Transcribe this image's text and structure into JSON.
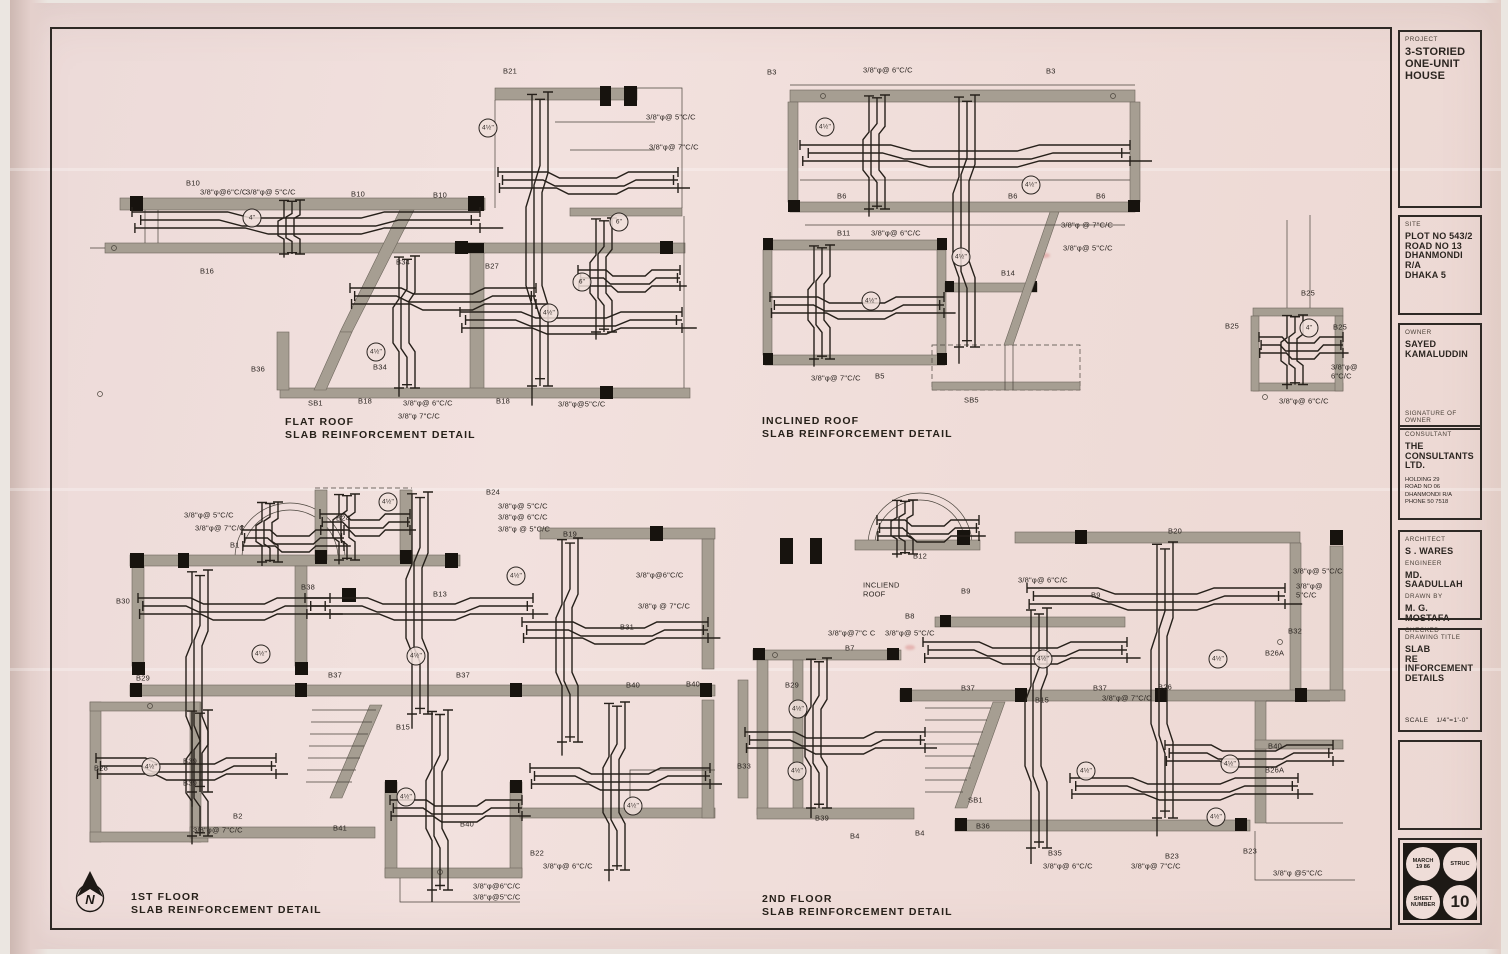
{
  "sheet": {
    "project": {
      "label": "PROJECT",
      "lines": [
        "3-STORIED",
        "ONE-UNIT",
        "HOUSE"
      ]
    },
    "site": {
      "label": "SITE",
      "lines": [
        "PLOT NO 543/2",
        "ROAD NO 13",
        "DHANMONDI R/A",
        "DHAKA 5"
      ]
    },
    "owner": {
      "label": "OWNER",
      "lines": [
        "SAYED",
        "KAMALUDDIN"
      ],
      "signature_label": "SIGNATURE OF OWNER"
    },
    "consultant": {
      "label": "CONSULTANT",
      "lines": [
        "THE",
        "CONSULTANTS",
        "LTD."
      ],
      "address": [
        "HOLDING  29",
        "ROAD NO  06",
        "DHANMONDI R/A",
        "PHONE  50 7518"
      ]
    },
    "team": {
      "architect_label": "ARCHITECT",
      "architect": "S . WARES",
      "engineer_label": "ENGINEER",
      "engineer": "MD. SAADULLAH",
      "drawn_label": "DRAWN BY",
      "drawn_by": "M. G. MOSTAFA",
      "checked_label": "CHECKED"
    },
    "title": {
      "label": "DRAWING TITLE",
      "lines": [
        "SLAB",
        "RE INFORCEMENT",
        "DETAILS"
      ],
      "scale_label": "SCALE",
      "scale": "1/4\"=1'-0\""
    },
    "stamp": {
      "date1": "MARCH",
      "date2": "19 86",
      "type": "STRUC",
      "sheet1": "SHEET",
      "sheet2": "NUMBER",
      "number": "10"
    }
  },
  "north_label": "N",
  "colors": {
    "paper": "#f0dfdc",
    "ink": "#2b2521",
    "wall": "#a69e92"
  },
  "drawings": {
    "flat_roof": {
      "title": "FLAT  ROOF",
      "subtitle": "SLAB  REINFORCEMENT  DETAIL",
      "annotations": [
        {
          "t": "B21",
          "x": 403,
          "y": 12
        },
        {
          "t": "3/8\"φ@ 5\"C/C",
          "x": 546,
          "y": 58
        },
        {
          "t": "3/8\"φ@ 7\"C/C",
          "x": 549,
          "y": 88
        },
        {
          "t": "B10",
          "x": 86,
          "y": 124
        },
        {
          "t": "3/8\"φ@6\"C/C",
          "x": 100,
          "y": 133
        },
        {
          "t": "3/8\"φ@ 5\"C/C",
          "x": 146,
          "y": 133
        },
        {
          "t": "4\"",
          "x": 152,
          "y": 158,
          "c": "circ"
        },
        {
          "t": "B16",
          "x": 100,
          "y": 212
        },
        {
          "t": "B10",
          "x": 251,
          "y": 135
        },
        {
          "t": "B10",
          "x": 333,
          "y": 136
        },
        {
          "t": "B27",
          "x": 385,
          "y": 207
        },
        {
          "t": "B34",
          "x": 296,
          "y": 203
        },
        {
          "t": "B34",
          "x": 273,
          "y": 308
        },
        {
          "t": "B36",
          "x": 151,
          "y": 310
        },
        {
          "t": "4½\"",
          "x": 388,
          "y": 68,
          "c": "circ"
        },
        {
          "t": "4½\"",
          "x": 276,
          "y": 292,
          "c": "circ"
        },
        {
          "t": "4½\"",
          "x": 449,
          "y": 253,
          "c": "circ"
        },
        {
          "t": "6\"",
          "x": 519,
          "y": 162,
          "c": "circ"
        },
        {
          "t": "6\"",
          "x": 482,
          "y": 222,
          "c": "circ"
        },
        {
          "t": "SB1",
          "x": 208,
          "y": 344
        },
        {
          "t": "B18",
          "x": 258,
          "y": 342
        },
        {
          "t": "3/8\"φ@ 6\"C/C",
          "x": 303,
          "y": 344
        },
        {
          "t": "3/8\"φ 7\"C/C",
          "x": 298,
          "y": 357
        },
        {
          "t": "B18",
          "x": 396,
          "y": 342
        },
        {
          "t": "3/8\"φ@5\"C/C",
          "x": 458,
          "y": 345
        }
      ]
    },
    "inclined_roof": {
      "title": "INCLINED  ROOF",
      "subtitle": "SLAB  REINFORCEMENT  DETAIL",
      "annotations": [
        {
          "t": "B3",
          "x": 22,
          "y": 18
        },
        {
          "t": "3/8\"φ@ 6\"C/C",
          "x": 118,
          "y": 16
        },
        {
          "t": "B3",
          "x": 301,
          "y": 17
        },
        {
          "t": "4½\"",
          "x": 80,
          "y": 72,
          "c": "circ"
        },
        {
          "t": "4½\"",
          "x": 286,
          "y": 130,
          "c": "circ"
        },
        {
          "t": "B6",
          "x": 92,
          "y": 142
        },
        {
          "t": "B6",
          "x": 263,
          "y": 142
        },
        {
          "t": "B6",
          "x": 351,
          "y": 142
        },
        {
          "t": "3/8\"φ @ 7\"C/C",
          "x": 316,
          "y": 171
        },
        {
          "t": "3/8\"φ@ 5\"C/C",
          "x": 318,
          "y": 194
        },
        {
          "t": "B11",
          "x": 92,
          "y": 179
        },
        {
          "t": "3/8\"φ@ 6\"C/C",
          "x": 126,
          "y": 179
        },
        {
          "t": "4½\"",
          "x": 216,
          "y": 202,
          "c": "circ"
        },
        {
          "t": "4½\"",
          "x": 126,
          "y": 246,
          "c": "circ"
        },
        {
          "t": "B14",
          "x": 256,
          "y": 219
        },
        {
          "t": "3/8\"φ@ 7\"C/C",
          "x": 66,
          "y": 324
        },
        {
          "t": "B5",
          "x": 130,
          "y": 322
        },
        {
          "t": "SB5",
          "x": 219,
          "y": 346
        }
      ]
    },
    "b25_detail": {
      "annotations": [
        {
          "t": "B25",
          "x": 86,
          "y": 79
        },
        {
          "t": "B25",
          "x": 10,
          "y": 112
        },
        {
          "t": "B25",
          "x": 118,
          "y": 113
        },
        {
          "t": "4\"",
          "x": 94,
          "y": 113,
          "c": "circ"
        },
        {
          "t": "3/8\"φ@ 6\"C/C",
          "x": 116,
          "y": 157
        },
        {
          "t": "3/8\"φ@ 6\"C/C",
          "x": 64,
          "y": 187
        }
      ]
    },
    "first_floor": {
      "title": "1ST  FLOOR",
      "subtitle": "SLAB  REINFORCEMENT  DETAIL",
      "annotations": [
        {
          "t": "B24",
          "x": 396,
          "y": 23
        },
        {
          "t": "3/8\"φ@ 5\"C/C",
          "x": 408,
          "y": 37
        },
        {
          "t": "3/8\"φ@ 6\"C/C",
          "x": 408,
          "y": 48
        },
        {
          "t": "3/8\"φ @ 5\"C/C",
          "x": 408,
          "y": 60
        },
        {
          "t": "B24",
          "x": 246,
          "y": 49
        },
        {
          "t": "3/8\"φ@ 5\"C/C",
          "x": 94,
          "y": 46
        },
        {
          "t": "3/8\"φ@ 7\"C/C",
          "x": 105,
          "y": 59
        },
        {
          "t": "B1",
          "x": 140,
          "y": 76
        },
        {
          "t": "B13",
          "x": 343,
          "y": 125
        },
        {
          "t": "B19",
          "x": 473,
          "y": 65
        },
        {
          "t": "4½\"",
          "x": 298,
          "y": 32,
          "c": "circ"
        },
        {
          "t": "4½\"",
          "x": 426,
          "y": 106,
          "c": "circ"
        },
        {
          "t": "3/8\"φ@6\"C/C",
          "x": 546,
          "y": 106
        },
        {
          "t": "3/8\"φ @ 7\"C/C",
          "x": 548,
          "y": 137
        },
        {
          "t": "B30",
          "x": 26,
          "y": 132
        },
        {
          "t": "B38",
          "x": 211,
          "y": 118
        },
        {
          "t": "B31",
          "x": 530,
          "y": 158
        },
        {
          "t": "4½\"",
          "x": 171,
          "y": 184,
          "c": "circ"
        },
        {
          "t": "4½\"",
          "x": 326,
          "y": 186,
          "c": "circ"
        },
        {
          "t": "B29",
          "x": 46,
          "y": 209
        },
        {
          "t": "B37",
          "x": 238,
          "y": 206
        },
        {
          "t": "B37",
          "x": 366,
          "y": 206
        },
        {
          "t": "B40",
          "x": 536,
          "y": 216
        },
        {
          "t": "B40",
          "x": 596,
          "y": 215
        },
        {
          "t": "B15",
          "x": 306,
          "y": 258
        },
        {
          "t": "B39",
          "x": 93,
          "y": 292
        },
        {
          "t": "4½\"",
          "x": 61,
          "y": 297,
          "c": "circ"
        },
        {
          "t": "B28",
          "x": 4,
          "y": 299
        },
        {
          "t": "B39",
          "x": 93,
          "y": 314
        },
        {
          "t": "B2",
          "x": 143,
          "y": 347
        },
        {
          "t": "3/8\"φ@ 7\"C/C",
          "x": 103,
          "y": 361
        },
        {
          "t": "B41",
          "x": 243,
          "y": 359
        },
        {
          "t": "4½\"",
          "x": 316,
          "y": 327,
          "c": "circ"
        },
        {
          "t": "4½\"",
          "x": 543,
          "y": 336,
          "c": "circ"
        },
        {
          "t": "B40",
          "x": 370,
          "y": 355
        },
        {
          "t": "B22",
          "x": 440,
          "y": 384
        },
        {
          "t": "3/8\"φ@ 6\"C/C",
          "x": 453,
          "y": 397
        },
        {
          "t": "3/8\"φ@6\"C/C",
          "x": 383,
          "y": 417
        },
        {
          "t": "3/8\"φ@5\"C/C",
          "x": 383,
          "y": 428
        }
      ]
    },
    "second_floor": {
      "title": "2ND  FLOOR",
      "subtitle": "SLAB REINFORCEMENT  DETAIL",
      "annotations": [
        {
          "t": "B12",
          "x": 178,
          "y": 67
        },
        {
          "t": "B20",
          "x": 433,
          "y": 42
        },
        {
          "t": "3/8\"φ@ 5\"C/C",
          "x": 558,
          "y": 82
        },
        {
          "t": "3/8\"φ@ 5\"C/C",
          "x": 561,
          "y": 101
        },
        {
          "t": "INCLIEND\nROOF",
          "x": 128,
          "y": 100
        },
        {
          "t": "B9",
          "x": 226,
          "y": 102
        },
        {
          "t": "3/8\"φ@ 6\"C/C",
          "x": 283,
          "y": 91
        },
        {
          "t": "B9",
          "x": 356,
          "y": 106
        },
        {
          "t": "B8",
          "x": 170,
          "y": 127
        },
        {
          "t": "B32",
          "x": 553,
          "y": 142
        },
        {
          "t": "3/8\"φ@7\"C C",
          "x": 93,
          "y": 144
        },
        {
          "t": "3/8\"φ@ 5\"C/C",
          "x": 150,
          "y": 144
        },
        {
          "t": "B7",
          "x": 110,
          "y": 159
        },
        {
          "t": "4½\"",
          "x": 308,
          "y": 169,
          "c": "circ"
        },
        {
          "t": "4½\"",
          "x": 483,
          "y": 169,
          "c": "circ"
        },
        {
          "t": "B29",
          "x": 50,
          "y": 196
        },
        {
          "t": "3/8\"φ@ 7\"C/C",
          "x": 367,
          "y": 209
        },
        {
          "t": "B37",
          "x": 226,
          "y": 199
        },
        {
          "t": "B37",
          "x": 358,
          "y": 199
        },
        {
          "t": "B26",
          "x": 423,
          "y": 198
        },
        {
          "t": "B26A",
          "x": 530,
          "y": 164
        },
        {
          "t": "B15",
          "x": 300,
          "y": 211
        },
        {
          "t": "4½\"",
          "x": 63,
          "y": 219,
          "c": "circ"
        },
        {
          "t": "4½\"",
          "x": 351,
          "y": 281,
          "c": "circ"
        },
        {
          "t": "4½\"",
          "x": 495,
          "y": 274,
          "c": "circ"
        },
        {
          "t": "B40",
          "x": 533,
          "y": 257
        },
        {
          "t": "B26A",
          "x": 530,
          "y": 281
        },
        {
          "t": "B33",
          "x": 2,
          "y": 277
        },
        {
          "t": "4½\"",
          "x": 62,
          "y": 281,
          "c": "circ"
        },
        {
          "t": "B39",
          "x": 80,
          "y": 329
        },
        {
          "t": "SB1",
          "x": 233,
          "y": 311
        },
        {
          "t": "B36",
          "x": 241,
          "y": 337
        },
        {
          "t": "B4",
          "x": 115,
          "y": 347
        },
        {
          "t": "B4",
          "x": 180,
          "y": 344
        },
        {
          "t": "4½\"",
          "x": 481,
          "y": 327,
          "c": "circ"
        },
        {
          "t": "B35",
          "x": 313,
          "y": 364
        },
        {
          "t": "3/8\"φ@ 6\"C/C",
          "x": 308,
          "y": 377
        },
        {
          "t": "3/8\"φ@ 7\"C/C",
          "x": 396,
          "y": 377
        },
        {
          "t": "B23",
          "x": 430,
          "y": 367
        },
        {
          "t": "B23",
          "x": 508,
          "y": 362
        },
        {
          "t": "3/8\"φ @5\"C/C",
          "x": 538,
          "y": 384
        }
      ]
    }
  }
}
